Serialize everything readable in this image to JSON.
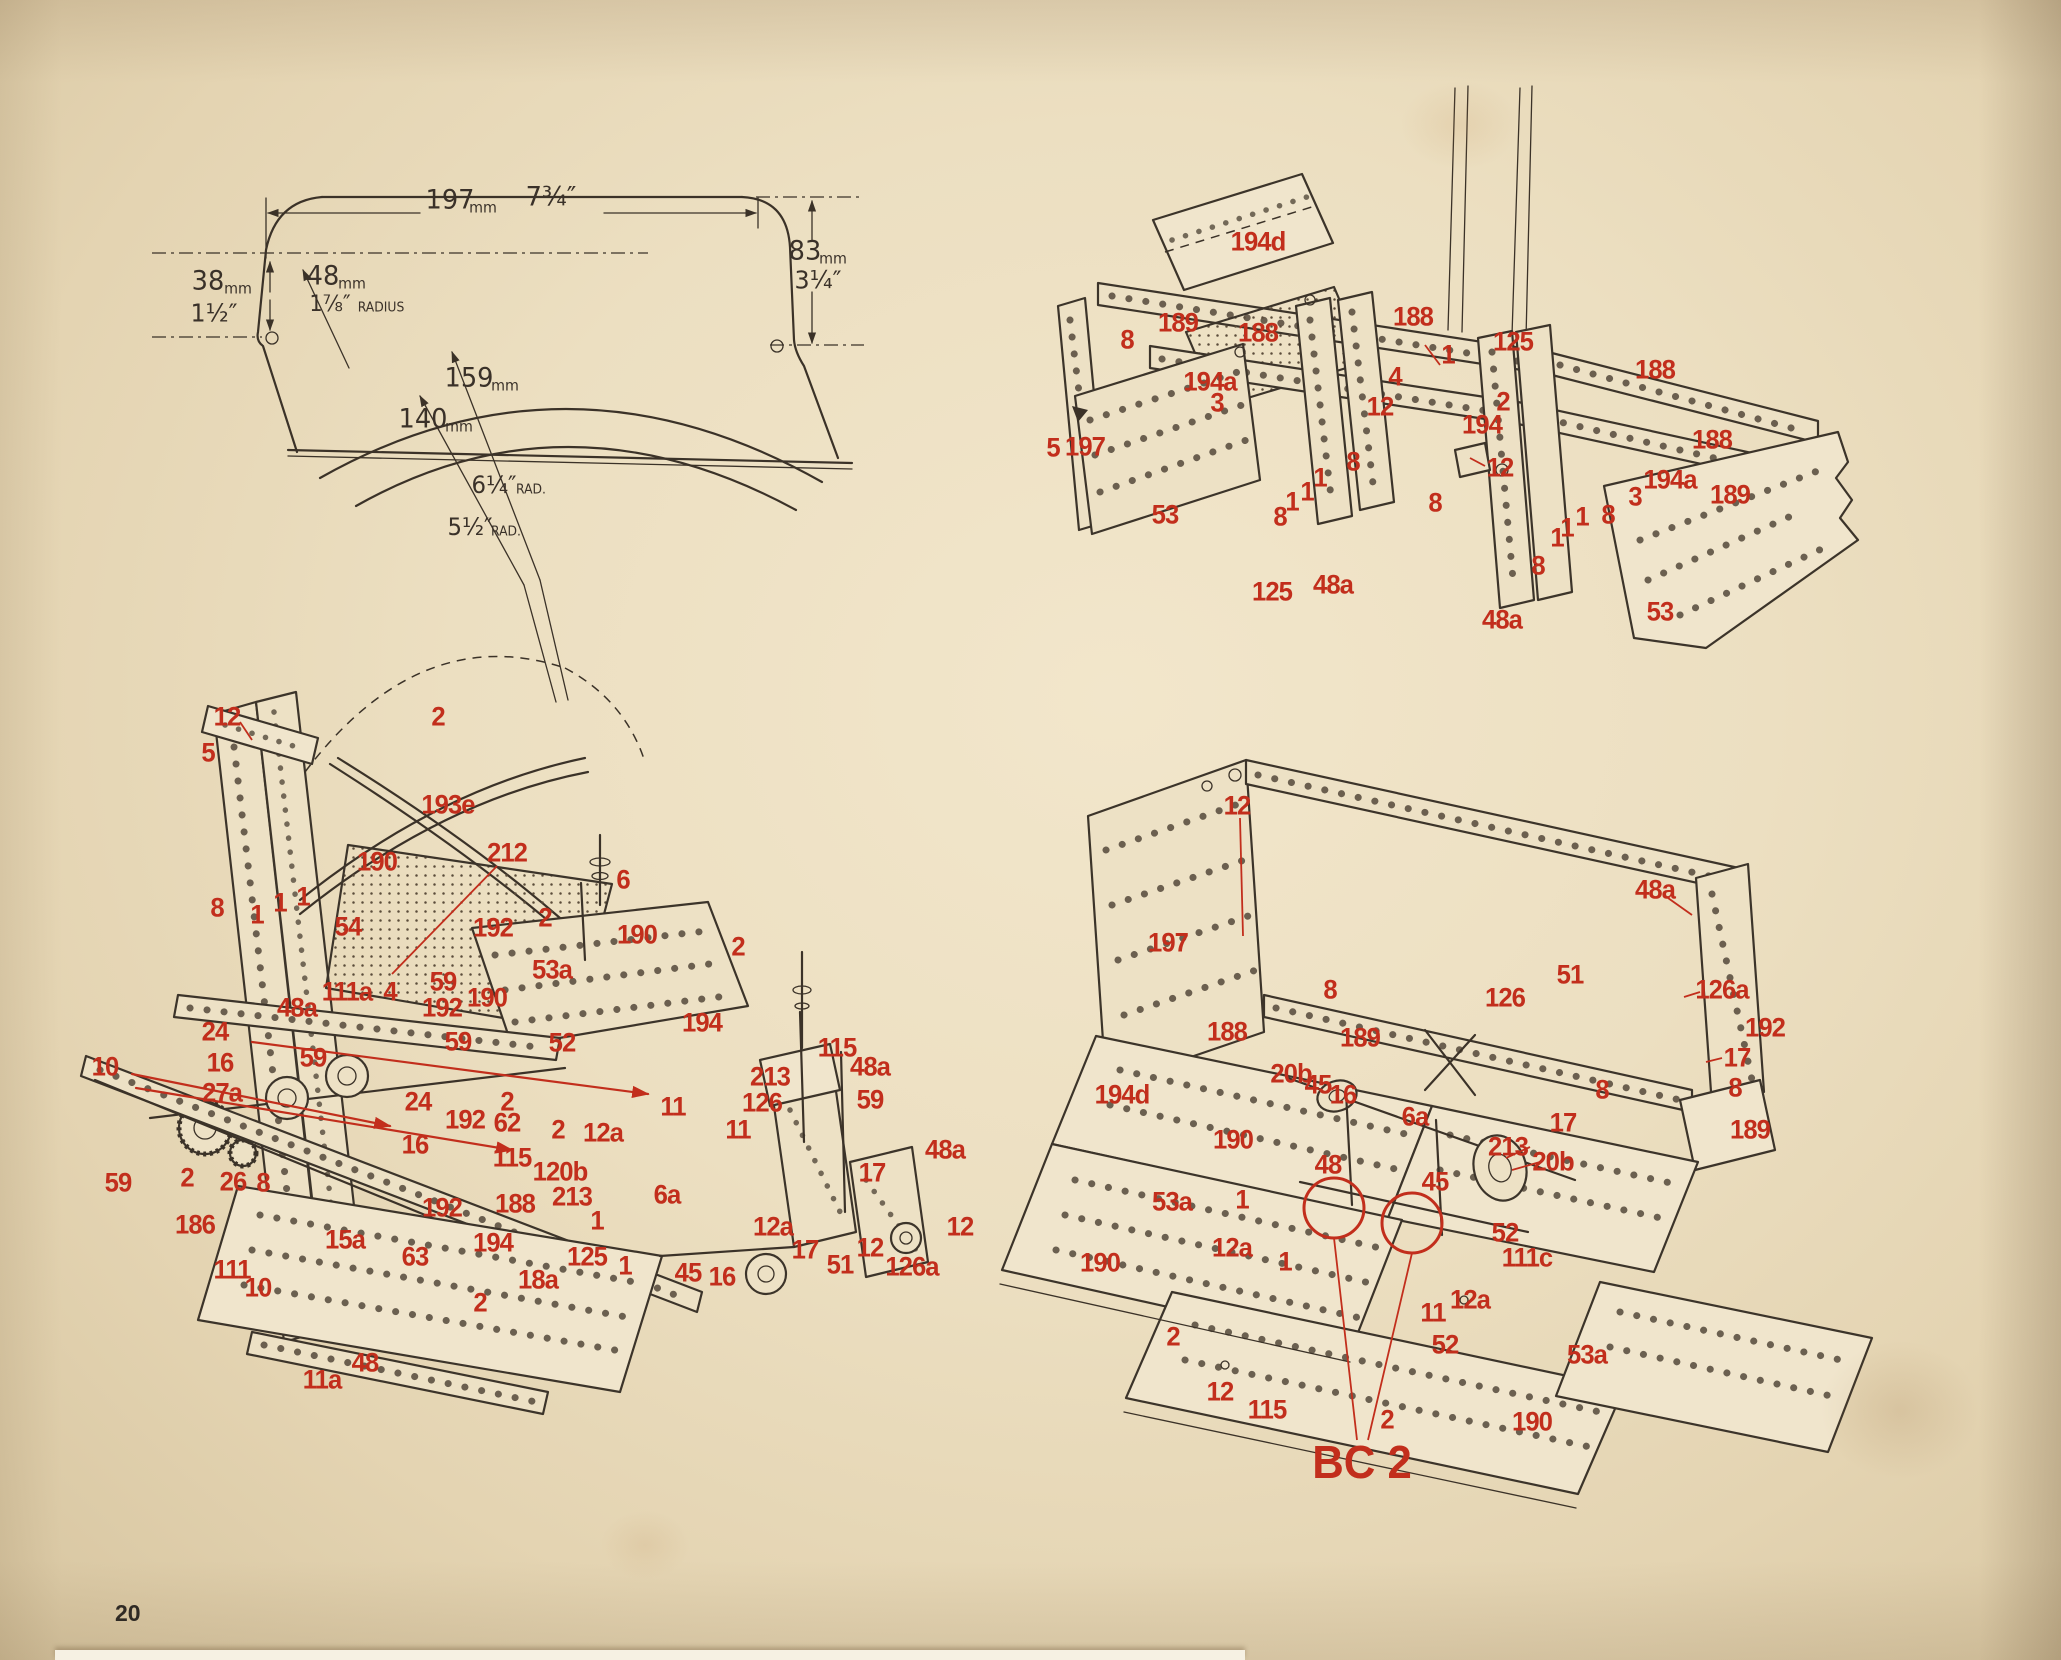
{
  "page_number": "20",
  "colors": {
    "paper": "#ecdfc1",
    "ink": "#3a3129",
    "red": "#c22e1c"
  },
  "label_groups": [
    {
      "name": "dimension-drawing",
      "style": "ink",
      "labels": [
        {
          "t": "197",
          "x": 450,
          "y": 200,
          "fs": 27
        },
        {
          "t": "mm",
          "x": 483,
          "y": 208,
          "fs": 15
        },
        {
          "t": "7¾″",
          "x": 551,
          "y": 197,
          "fs": 27
        },
        {
          "t": "38",
          "x": 208,
          "y": 281,
          "fs": 27
        },
        {
          "t": "mm",
          "x": 238,
          "y": 289,
          "fs": 15
        },
        {
          "t": "1½″",
          "x": 214,
          "y": 313,
          "fs": 25
        },
        {
          "t": "48",
          "x": 323,
          "y": 276,
          "fs": 27
        },
        {
          "t": "mm",
          "x": 352,
          "y": 284,
          "fs": 15
        },
        {
          "t": "1⅞″",
          "x": 330,
          "y": 305,
          "fs": 22
        },
        {
          "t": "RADIUS",
          "x": 381,
          "y": 308,
          "fs": 13
        },
        {
          "t": "159",
          "x": 469,
          "y": 378,
          "fs": 27
        },
        {
          "t": "mm",
          "x": 505,
          "y": 386,
          "fs": 15
        },
        {
          "t": "140",
          "x": 423,
          "y": 419,
          "fs": 27
        },
        {
          "t": "mm",
          "x": 459,
          "y": 427,
          "fs": 15
        },
        {
          "t": "6¼″",
          "x": 494,
          "y": 485,
          "fs": 24
        },
        {
          "t": "RAD.",
          "x": 531,
          "y": 490,
          "fs": 13
        },
        {
          "t": "5½″",
          "x": 470,
          "y": 527,
          "fs": 24
        },
        {
          "t": "RAD.",
          "x": 506,
          "y": 532,
          "fs": 13
        },
        {
          "t": "83",
          "x": 805,
          "y": 251,
          "fs": 27
        },
        {
          "t": "mm",
          "x": 833,
          "y": 259,
          "fs": 15
        },
        {
          "t": "3¼″",
          "x": 818,
          "y": 280,
          "fs": 25
        }
      ]
    },
    {
      "name": "top-right-assembly",
      "style": "red",
      "labels": [
        {
          "t": "194d",
          "x": 1258,
          "y": 242
        },
        {
          "t": "189",
          "x": 1178,
          "y": 323
        },
        {
          "t": "8",
          "x": 1127,
          "y": 340
        },
        {
          "t": "188",
          "x": 1258,
          "y": 333
        },
        {
          "t": "194a",
          "x": 1210,
          "y": 382
        },
        {
          "t": "3",
          "x": 1217,
          "y": 403
        },
        {
          "t": "188",
          "x": 1413,
          "y": 317
        },
        {
          "t": "1",
          "x": 1448,
          "y": 355
        },
        {
          "t": "4",
          "x": 1395,
          "y": 377
        },
        {
          "t": "12",
          "x": 1380,
          "y": 407
        },
        {
          "t": "2",
          "x": 1503,
          "y": 402
        },
        {
          "t": "194",
          "x": 1482,
          "y": 425
        },
        {
          "t": "125",
          "x": 1513,
          "y": 342
        },
        {
          "t": "197",
          "x": 1085,
          "y": 447
        },
        {
          "t": "5",
          "x": 1053,
          "y": 448
        },
        {
          "t": "53",
          "x": 1165,
          "y": 515
        },
        {
          "t": "8",
          "x": 1280,
          "y": 517
        },
        {
          "t": "1",
          "x": 1292,
          "y": 502
        },
        {
          "t": "1",
          "x": 1307,
          "y": 492
        },
        {
          "t": "1",
          "x": 1320,
          "y": 478
        },
        {
          "t": "8",
          "x": 1353,
          "y": 462
        },
        {
          "t": "125",
          "x": 1272,
          "y": 592
        },
        {
          "t": "48a",
          "x": 1333,
          "y": 585
        },
        {
          "t": "8",
          "x": 1435,
          "y": 503
        },
        {
          "t": "12",
          "x": 1500,
          "y": 468
        },
        {
          "t": "188",
          "x": 1655,
          "y": 370
        },
        {
          "t": "188",
          "x": 1712,
          "y": 440
        },
        {
          "t": "194a",
          "x": 1670,
          "y": 480
        },
        {
          "t": "189",
          "x": 1730,
          "y": 495
        },
        {
          "t": "3",
          "x": 1635,
          "y": 497
        },
        {
          "t": "8",
          "x": 1608,
          "y": 515
        },
        {
          "t": "1",
          "x": 1582,
          "y": 517
        },
        {
          "t": "1",
          "x": 1567,
          "y": 528
        },
        {
          "t": "1",
          "x": 1557,
          "y": 538
        },
        {
          "t": "8",
          "x": 1538,
          "y": 566
        },
        {
          "t": "48a",
          "x": 1502,
          "y": 620
        },
        {
          "t": "53",
          "x": 1660,
          "y": 612
        }
      ]
    },
    {
      "name": "bottom-left-assembly",
      "style": "red",
      "labels": [
        {
          "t": "12",
          "x": 227,
          "y": 717
        },
        {
          "t": "5",
          "x": 208,
          "y": 753
        },
        {
          "t": "2",
          "x": 438,
          "y": 717
        },
        {
          "t": "193e",
          "x": 448,
          "y": 805
        },
        {
          "t": "190",
          "x": 377,
          "y": 862
        },
        {
          "t": "212",
          "x": 507,
          "y": 853
        },
        {
          "t": "8",
          "x": 217,
          "y": 908
        },
        {
          "t": "1",
          "x": 257,
          "y": 915
        },
        {
          "t": "1",
          "x": 280,
          "y": 903
        },
        {
          "t": "1",
          "x": 303,
          "y": 897
        },
        {
          "t": "54",
          "x": 348,
          "y": 927
        },
        {
          "t": "192",
          "x": 493,
          "y": 928
        },
        {
          "t": "2",
          "x": 545,
          "y": 918
        },
        {
          "t": "6",
          "x": 623,
          "y": 880
        },
        {
          "t": "190",
          "x": 637,
          "y": 935
        },
        {
          "t": "53a",
          "x": 552,
          "y": 970
        },
        {
          "t": "2",
          "x": 738,
          "y": 947
        },
        {
          "t": "59",
          "x": 443,
          "y": 982
        },
        {
          "t": "111a",
          "x": 347,
          "y": 992
        },
        {
          "t": "4",
          "x": 390,
          "y": 992
        },
        {
          "t": "48a",
          "x": 297,
          "y": 1008
        },
        {
          "t": "190",
          "x": 487,
          "y": 998
        },
        {
          "t": "192",
          "x": 442,
          "y": 1008
        },
        {
          "t": "59",
          "x": 458,
          "y": 1042
        },
        {
          "t": "52",
          "x": 562,
          "y": 1043
        },
        {
          "t": "194",
          "x": 702,
          "y": 1023
        },
        {
          "t": "24",
          "x": 215,
          "y": 1032
        },
        {
          "t": "16",
          "x": 220,
          "y": 1063
        },
        {
          "t": "27a",
          "x": 222,
          "y": 1093
        },
        {
          "t": "10",
          "x": 105,
          "y": 1067
        },
        {
          "t": "59",
          "x": 313,
          "y": 1058
        },
        {
          "t": "115",
          "x": 837,
          "y": 1048
        },
        {
          "t": "48a",
          "x": 870,
          "y": 1067
        },
        {
          "t": "59",
          "x": 870,
          "y": 1100
        },
        {
          "t": "213",
          "x": 770,
          "y": 1077
        },
        {
          "t": "126",
          "x": 762,
          "y": 1103
        },
        {
          "t": "11",
          "x": 673,
          "y": 1107
        },
        {
          "t": "24",
          "x": 418,
          "y": 1102
        },
        {
          "t": "2",
          "x": 507,
          "y": 1102
        },
        {
          "t": "192",
          "x": 465,
          "y": 1120
        },
        {
          "t": "62",
          "x": 507,
          "y": 1123
        },
        {
          "t": "2",
          "x": 558,
          "y": 1130
        },
        {
          "t": "12a",
          "x": 603,
          "y": 1133
        },
        {
          "t": "11",
          "x": 738,
          "y": 1130
        },
        {
          "t": "16",
          "x": 415,
          "y": 1145
        },
        {
          "t": "115",
          "x": 512,
          "y": 1158
        },
        {
          "t": "120b",
          "x": 560,
          "y": 1172
        },
        {
          "t": "48a",
          "x": 945,
          "y": 1150
        },
        {
          "t": "17",
          "x": 872,
          "y": 1173
        },
        {
          "t": "213",
          "x": 572,
          "y": 1197
        },
        {
          "t": "188",
          "x": 515,
          "y": 1204
        },
        {
          "t": "6a",
          "x": 667,
          "y": 1195
        },
        {
          "t": "59",
          "x": 118,
          "y": 1183
        },
        {
          "t": "2",
          "x": 187,
          "y": 1178
        },
        {
          "t": "26",
          "x": 233,
          "y": 1182
        },
        {
          "t": "8",
          "x": 263,
          "y": 1183
        },
        {
          "t": "192",
          "x": 442,
          "y": 1208
        },
        {
          "t": "186",
          "x": 195,
          "y": 1225
        },
        {
          "t": "194",
          "x": 493,
          "y": 1243
        },
        {
          "t": "15a",
          "x": 345,
          "y": 1240
        },
        {
          "t": "63",
          "x": 415,
          "y": 1257
        },
        {
          "t": "125",
          "x": 587,
          "y": 1257
        },
        {
          "t": "12a",
          "x": 773,
          "y": 1227
        },
        {
          "t": "12",
          "x": 960,
          "y": 1227
        },
        {
          "t": "111",
          "x": 232,
          "y": 1270
        },
        {
          "t": "10",
          "x": 258,
          "y": 1288
        },
        {
          "t": "18a",
          "x": 538,
          "y": 1280
        },
        {
          "t": "45",
          "x": 688,
          "y": 1273
        },
        {
          "t": "16",
          "x": 722,
          "y": 1277
        },
        {
          "t": "17",
          "x": 805,
          "y": 1250
        },
        {
          "t": "51",
          "x": 840,
          "y": 1265
        },
        {
          "t": "12",
          "x": 870,
          "y": 1248
        },
        {
          "t": "126a",
          "x": 912,
          "y": 1267
        },
        {
          "t": "2",
          "x": 480,
          "y": 1303
        },
        {
          "t": "1",
          "x": 597,
          "y": 1221
        },
        {
          "t": "1",
          "x": 625,
          "y": 1266
        },
        {
          "t": "48",
          "x": 365,
          "y": 1363
        },
        {
          "t": "11a",
          "x": 322,
          "y": 1380
        }
      ]
    },
    {
      "name": "bottom-right-assembly",
      "style": "red",
      "labels": [
        {
          "t": "12",
          "x": 1237,
          "y": 806
        },
        {
          "t": "48a",
          "x": 1655,
          "y": 890
        },
        {
          "t": "197",
          "x": 1168,
          "y": 943
        },
        {
          "t": "51",
          "x": 1570,
          "y": 975
        },
        {
          "t": "126",
          "x": 1505,
          "y": 998
        },
        {
          "t": "126a",
          "x": 1722,
          "y": 990
        },
        {
          "t": "192",
          "x": 1765,
          "y": 1028
        },
        {
          "t": "17",
          "x": 1737,
          "y": 1058
        },
        {
          "t": "8",
          "x": 1735,
          "y": 1088
        },
        {
          "t": "188",
          "x": 1227,
          "y": 1032
        },
        {
          "t": "8",
          "x": 1330,
          "y": 990
        },
        {
          "t": "189",
          "x": 1360,
          "y": 1038
        },
        {
          "t": "189",
          "x": 1750,
          "y": 1130
        },
        {
          "t": "194d",
          "x": 1122,
          "y": 1095
        },
        {
          "t": "20b",
          "x": 1291,
          "y": 1074
        },
        {
          "t": "45",
          "x": 1318,
          "y": 1085
        },
        {
          "t": "16",
          "x": 1343,
          "y": 1095
        },
        {
          "t": "6a",
          "x": 1415,
          "y": 1117
        },
        {
          "t": "8",
          "x": 1602,
          "y": 1090
        },
        {
          "t": "17",
          "x": 1563,
          "y": 1123
        },
        {
          "t": "213",
          "x": 1508,
          "y": 1147
        },
        {
          "t": "20b",
          "x": 1553,
          "y": 1162
        },
        {
          "t": "190",
          "x": 1233,
          "y": 1140
        },
        {
          "t": "48",
          "x": 1328,
          "y": 1165
        },
        {
          "t": "45",
          "x": 1435,
          "y": 1182
        },
        {
          "t": "53a",
          "x": 1172,
          "y": 1202
        },
        {
          "t": "1",
          "x": 1242,
          "y": 1200
        },
        {
          "t": "12a",
          "x": 1232,
          "y": 1248
        },
        {
          "t": "1",
          "x": 1285,
          "y": 1262
        },
        {
          "t": "190",
          "x": 1100,
          "y": 1263
        },
        {
          "t": "52",
          "x": 1505,
          "y": 1233
        },
        {
          "t": "111c",
          "x": 1527,
          "y": 1258
        },
        {
          "t": "12a",
          "x": 1470,
          "y": 1300
        },
        {
          "t": "11",
          "x": 1433,
          "y": 1313
        },
        {
          "t": "2",
          "x": 1173,
          "y": 1337
        },
        {
          "t": "52",
          "x": 1445,
          "y": 1345
        },
        {
          "t": "53a",
          "x": 1587,
          "y": 1355
        },
        {
          "t": "12",
          "x": 1220,
          "y": 1392
        },
        {
          "t": "115",
          "x": 1267,
          "y": 1410
        },
        {
          "t": "2",
          "x": 1387,
          "y": 1420
        },
        {
          "t": "190",
          "x": 1532,
          "y": 1422
        },
        {
          "t": "BC 2",
          "x": 1362,
          "y": 1462,
          "big": true
        }
      ]
    }
  ]
}
